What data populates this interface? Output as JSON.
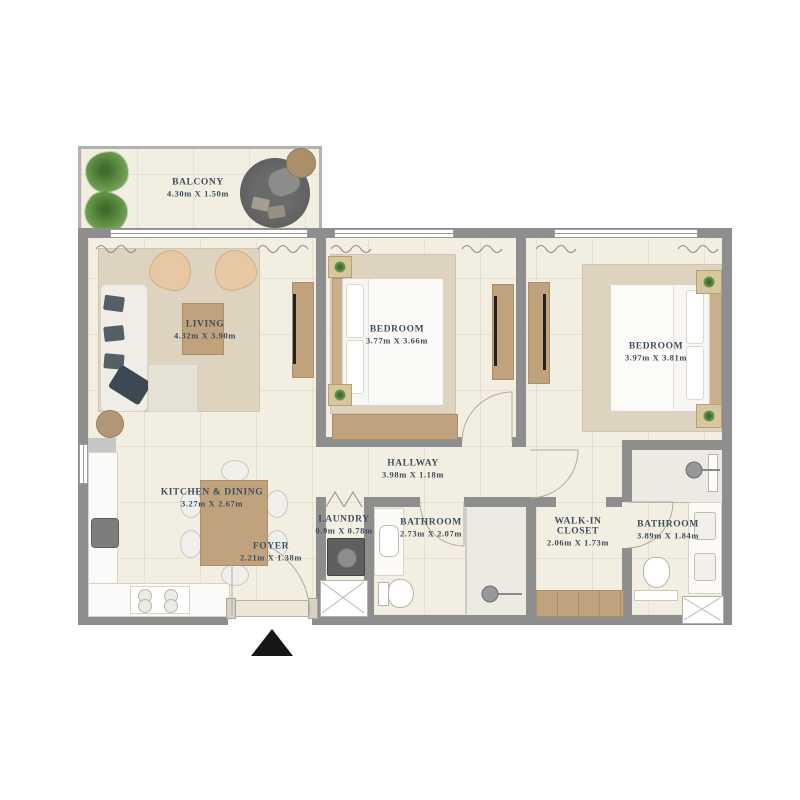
{
  "meta": {
    "type": "apartment-floor-plan",
    "bedrooms": 2,
    "has_balcony": true
  },
  "colors": {
    "wall": "#8e8e8e",
    "floor": "#f2eee1",
    "rug": "#ddd3bf",
    "wood": "#c0a27c",
    "label_text": "#3e4e5e",
    "plant_green": "#6f9d52",
    "balcony_rug_gray": "#5e5e5e",
    "door_arc": "#b3ab9b",
    "entry_arrow": "#161616"
  },
  "rooms": {
    "balcony": {
      "name": "BALCONY",
      "dims": "4.30m X 1.50m"
    },
    "living": {
      "name": "LIVING",
      "dims": "4.32m X 3.90m"
    },
    "bedroom1": {
      "name": "BEDROOM",
      "dims": "3.77m X 3.66m"
    },
    "bedroom2": {
      "name": "BEDROOM",
      "dims": "3.97m X 3.81m"
    },
    "hallway": {
      "name": "HALLWAY",
      "dims": "3.98m X 1.18m"
    },
    "kitchen_dining": {
      "name": "KITCHEN & DINING",
      "dims": "3.27m X 2.67m"
    },
    "foyer": {
      "name": "FOYER",
      "dims": "2.21m X 1.38m"
    },
    "laundry": {
      "name": "LAUNDRY",
      "dims": "0.9m X 0.78m"
    },
    "bathroom1": {
      "name": "BATHROOM",
      "dims": "2.73m X 2.07m"
    },
    "walk_in_closet": {
      "name": "WALK-IN",
      "name2": "CLOSET",
      "dims": "2.06m X 1.73m"
    },
    "bathroom2": {
      "name": "BATHROOM",
      "dims": "3.89m X 1.84m"
    }
  }
}
